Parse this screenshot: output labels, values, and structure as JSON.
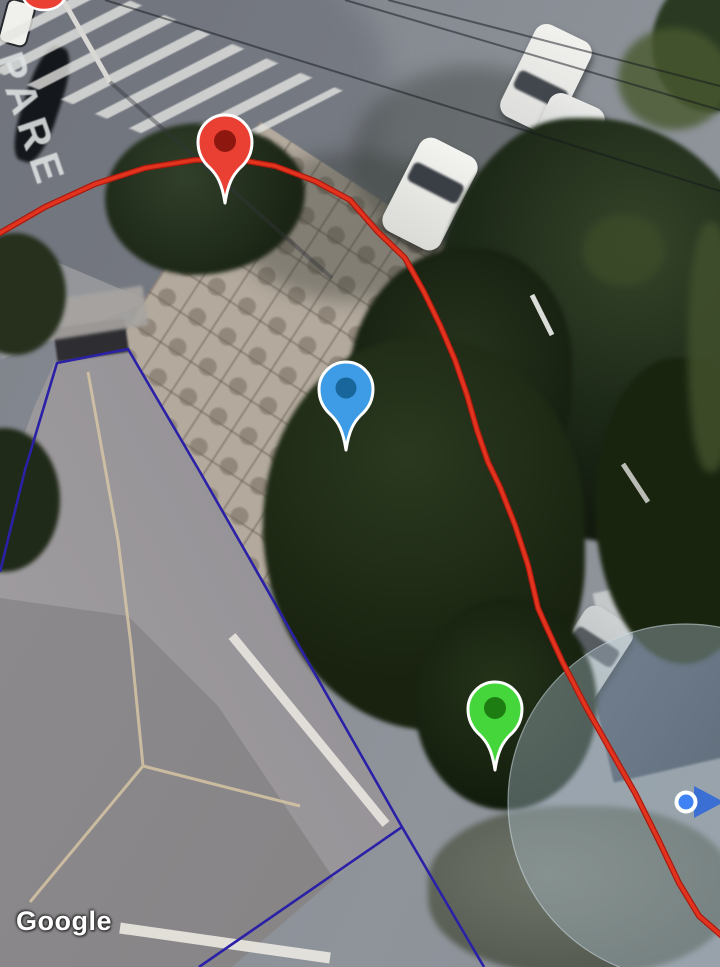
{
  "app": {
    "type": "map-satellite-view"
  },
  "watermark": {
    "text": "Google"
  },
  "road_marking": {
    "text": "PARE"
  },
  "markers": {
    "red": {
      "label": "red-pin",
      "color": "#EA4034",
      "inner_color": "#8E1810",
      "outline": "#FFFFFF",
      "x": 225,
      "y": 141
    },
    "blue": {
      "label": "blue-pin",
      "color": "#3D9CE5",
      "inner_color": "#19669C",
      "outline": "#FFFFFF",
      "x": 346,
      "y": 388
    },
    "green": {
      "label": "green-pin",
      "color": "#45D63B",
      "inner_color": "#1E7D12",
      "outline": "#FFFFFF",
      "x": 495,
      "y": 708
    }
  },
  "user_location": {
    "color": "#3E82F4",
    "heading_color": "#3B6FD4",
    "ring_color": "#FFFFFF",
    "x": 686,
    "y": 802,
    "accuracy_radius": 178,
    "accuracy_fill": "rgba(172,192,206,0.40)",
    "accuracy_stroke": "rgba(210,224,233,0.55)"
  },
  "route": {
    "color": "#E2331F",
    "casing_color": "#A81A0E"
  },
  "boundary": {
    "color": "#2B21A6"
  }
}
